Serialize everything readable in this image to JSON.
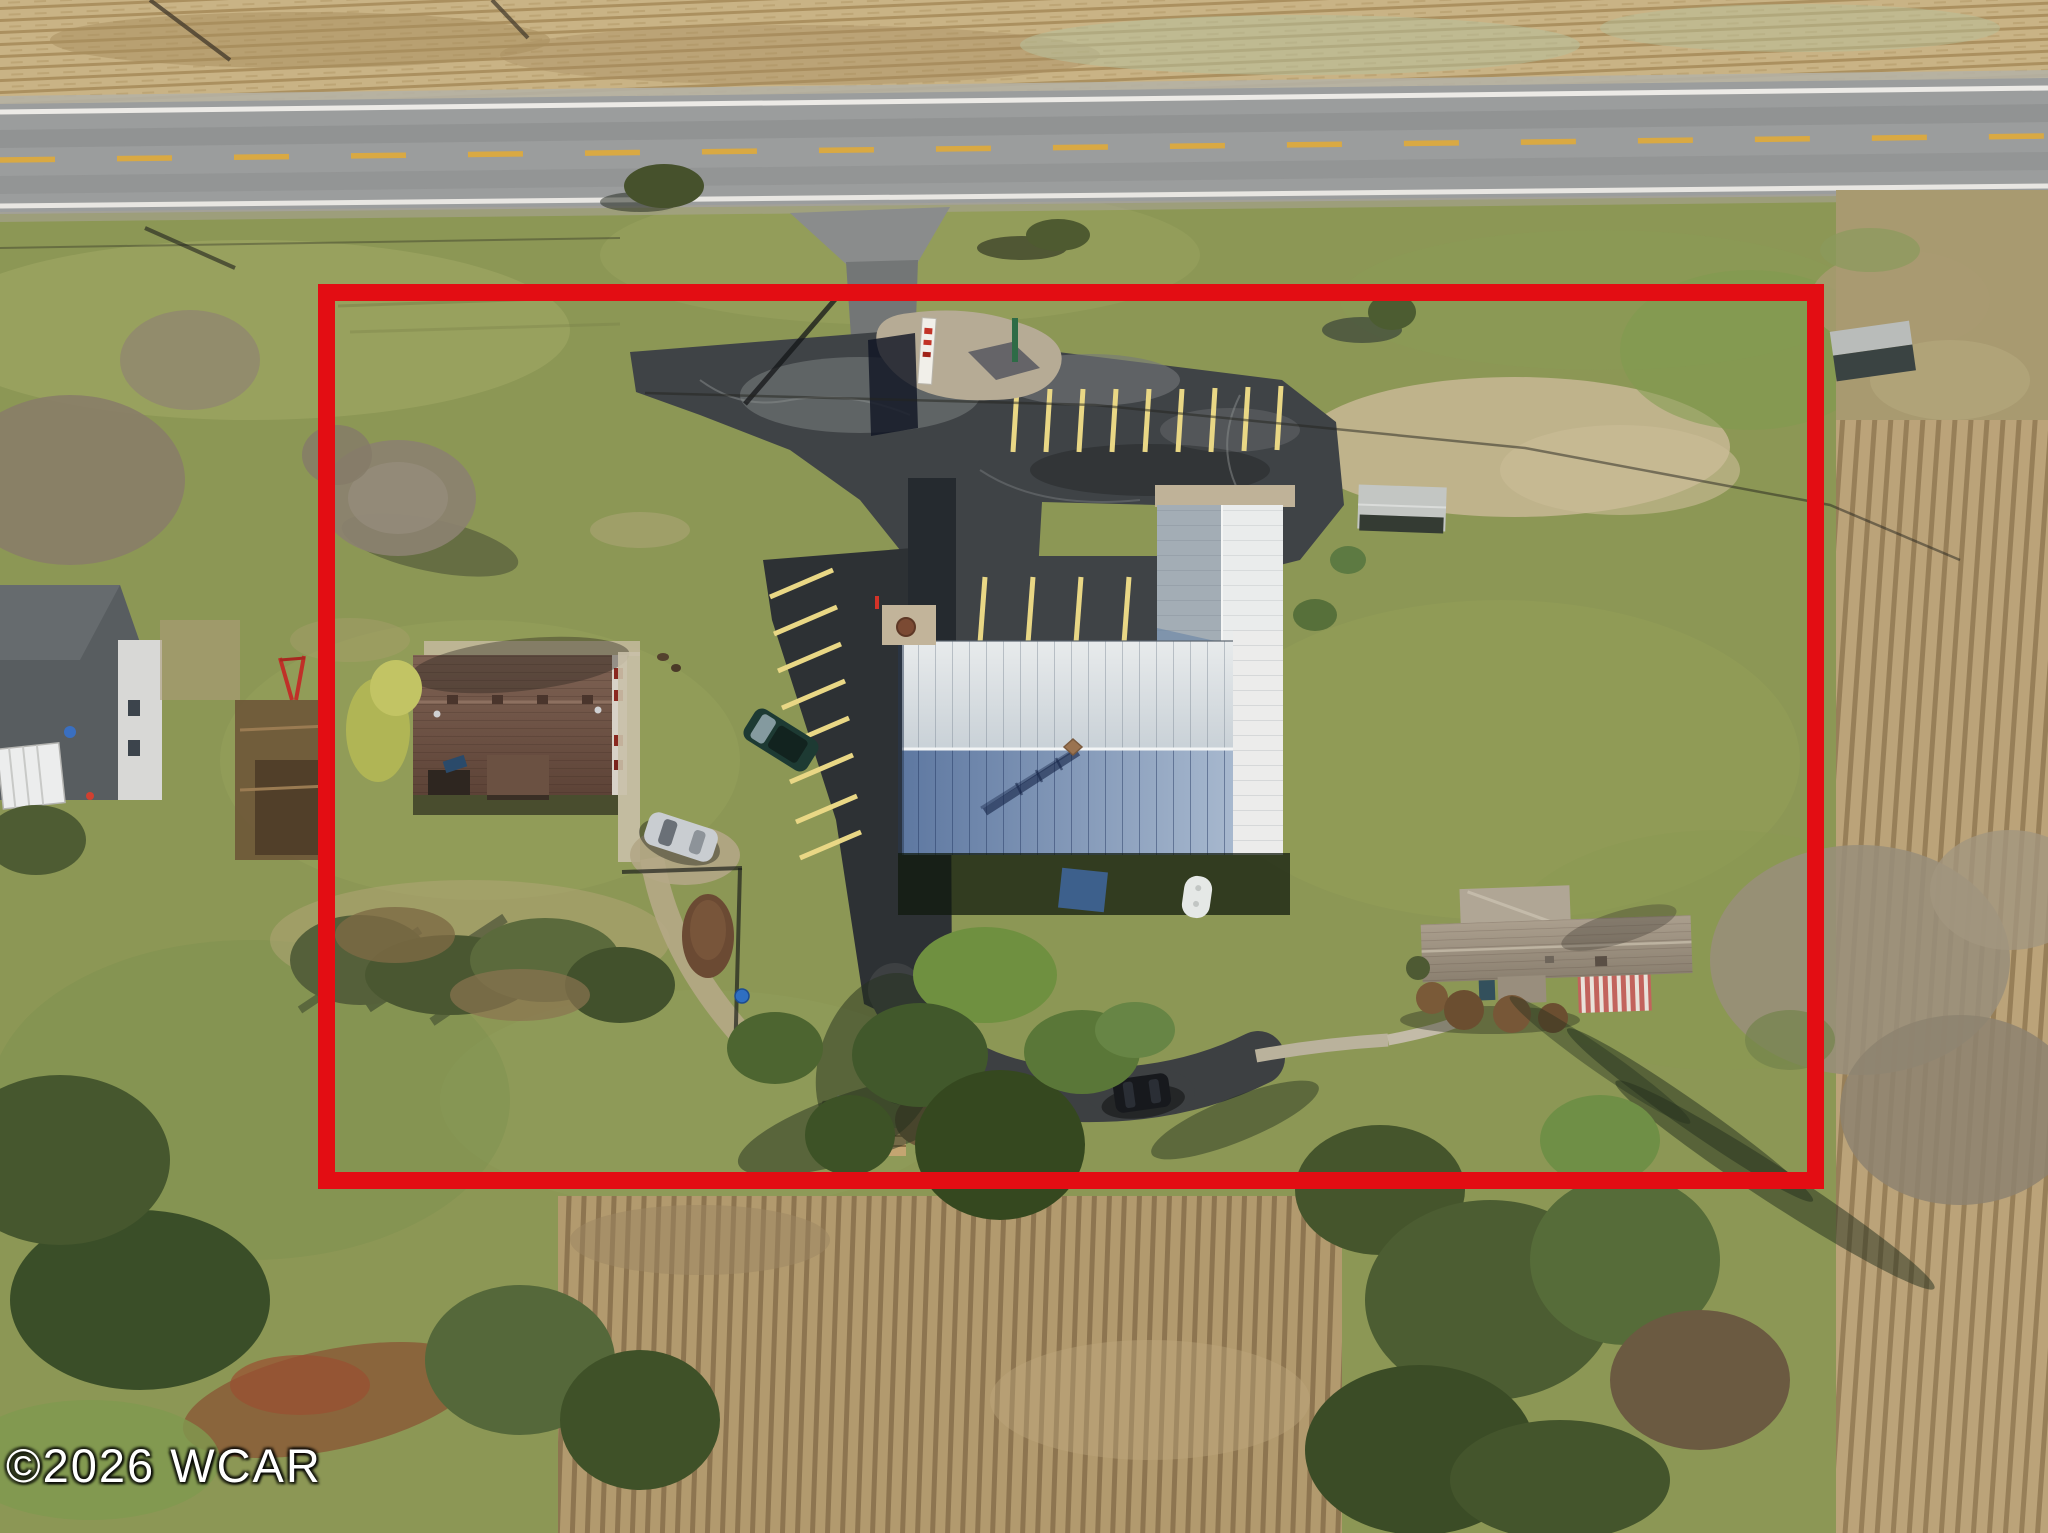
{
  "photo": {
    "kind": "aerial-drone-photo",
    "subject": "rural commercial property with red outlined lot boundary"
  },
  "watermark": {
    "text": "©2026 WCAR"
  },
  "annotation": {
    "boundary_color": "#e30d13",
    "boundary_shape": "rectangle"
  },
  "palette": {
    "grass": "#8c9755",
    "asphalt_dark": "#2d3134",
    "asphalt_mid": "#3f4346",
    "road_gray": "#9b9d9d",
    "field_tan": "#c9b385",
    "roof_white": "#e2e6e7",
    "roof_blue": "#7b93b4",
    "roof_brown": "#6f5346",
    "stripe_yellow": "#e9d785"
  },
  "features": [
    {
      "name": "road",
      "label": "two-lane paved road with yellow center line"
    },
    {
      "name": "entrance-driveway",
      "label": "asphalt entrance from road"
    },
    {
      "name": "parking-lot",
      "label": "dark asphalt parking lot with yellow striped spaces"
    },
    {
      "name": "main-building",
      "label": "large metal-roof commercial building with north wing"
    },
    {
      "name": "left-building",
      "label": "brown shingle-roof outbuilding"
    },
    {
      "name": "right-house",
      "label": "gray-roof ranch house with striped awning"
    },
    {
      "name": "pavilion",
      "label": "small picnic shelter"
    },
    {
      "name": "storage-shed",
      "label": "small white gable shed with debris pile"
    },
    {
      "name": "roadside-shed",
      "label": "small shed outside east boundary"
    },
    {
      "name": "green-suv",
      "label": "dark green SUV parked at lot edge"
    },
    {
      "name": "silver-car",
      "label": "silver car on gravel drive"
    },
    {
      "name": "black-suv",
      "label": "black SUV on rear driveway"
    },
    {
      "name": "propane-tank",
      "label": "white propane tank behind building"
    },
    {
      "name": "banner-sign",
      "label": "white and red sign at entrance"
    },
    {
      "name": "gravel-pad",
      "label": "gravel pad with pole near entrance"
    },
    {
      "name": "tilled-field-east",
      "label": "plowed farm field east of boundary"
    },
    {
      "name": "tilled-field-south",
      "label": "plowed farm field south of boundary"
    },
    {
      "name": "top-field",
      "label": "dry grass field north of road"
    },
    {
      "name": "neighbor-house",
      "label": "neighboring house west of boundary"
    },
    {
      "name": "trees",
      "label": "bare and evergreen tree groups"
    }
  ]
}
